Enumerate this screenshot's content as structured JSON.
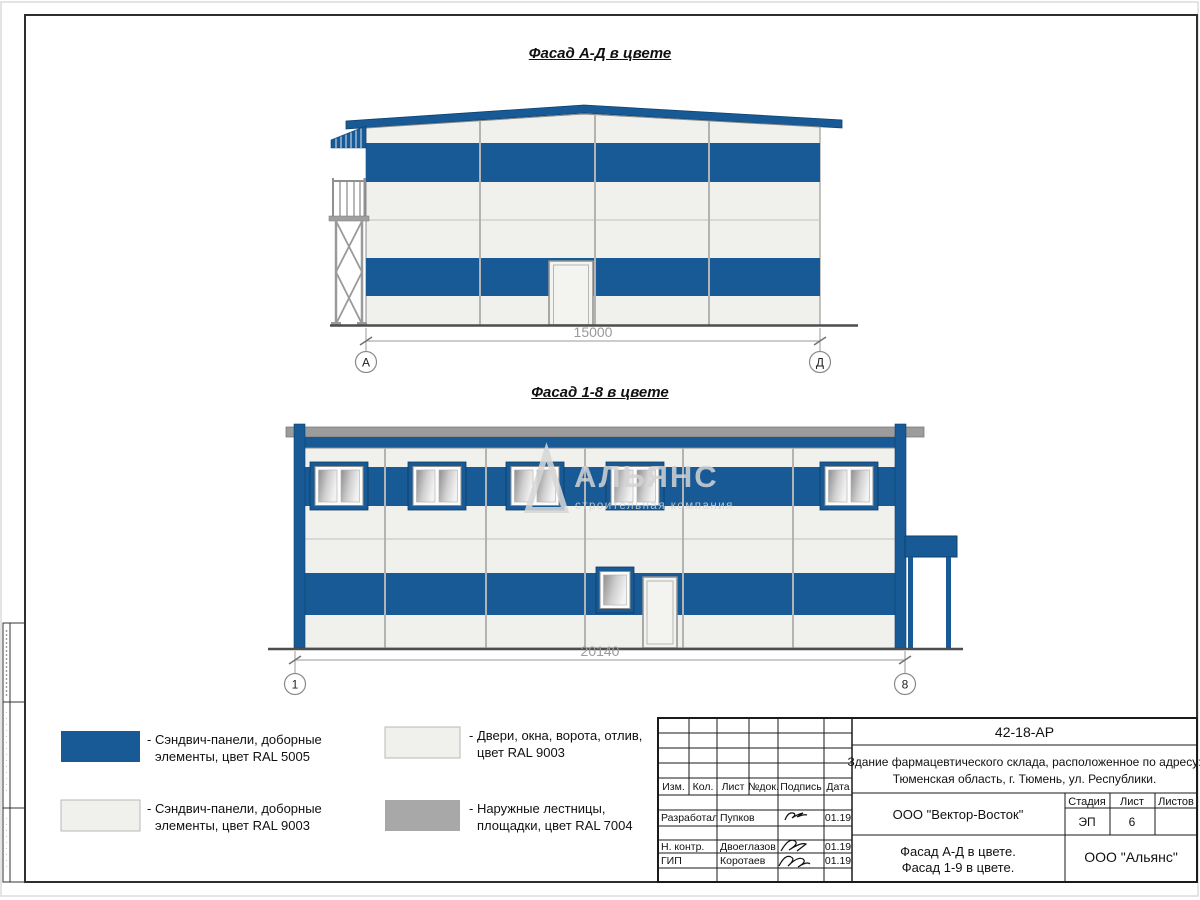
{
  "colors": {
    "blue_ral5005": "#175a96",
    "white_ral9003": "#f0f0ec",
    "gray_ral7004": "#a8a8a8",
    "roof_gray": "#9c9c9c",
    "dim_gray": "#9a9a9a"
  },
  "facade1": {
    "title": "Фасад А-Д в цвете",
    "dimension": "15000",
    "axis_left": "А",
    "axis_right": "Д"
  },
  "facade2": {
    "title": "Фасад 1-8 в цвете",
    "dimension": "20140",
    "axis_left": "1",
    "axis_right": "8"
  },
  "watermark": {
    "name": "АЛЬЯНС",
    "tagline": "строительная компания"
  },
  "legend": {
    "item1_line1": "- Сэндвич-панели, доборные",
    "item1_line2": "элементы, цвет RAL 5005",
    "item2_line1": "- Сэндвич-панели, доборные",
    "item2_line2": "элементы, цвет RAL 9003",
    "item3_line1": "- Двери, окна, ворота, отлив,",
    "item3_line2": "цвет RAL 9003",
    "item4_line1": "- Наружные лестницы,",
    "item4_line2": "площадки, цвет RAL 7004"
  },
  "titleblock": {
    "doc_number": "42-18-АР",
    "project_line1": "Здание фармацевтического склада, расположенное по адресу:",
    "project_line2": "Тюменская область, г. Тюмень, ул. Республики.",
    "col_izm": "Изм.",
    "col_kol": "Кол.",
    "col_list": "Лист",
    "col_ndok": "№док.",
    "col_podpis": "Подпись",
    "col_data": "Дата",
    "row1_role": "Разработал",
    "row1_name": "Пупков",
    "row1_date": "01.19",
    "row2_role": "Н. контр.",
    "row2_name": "Двоеглазов",
    "row2_date": "01.19",
    "row3_role": "ГИП",
    "row3_name": "Коротаев",
    "row3_date": "01.19",
    "company": "ООО \"Вектор-Восток\"",
    "stage_label": "Стадия",
    "sheet_label": "Лист",
    "sheets_label": "Листов",
    "stage_value": "ЭП",
    "sheet_value": "6",
    "sheets_value": "",
    "title_line1": "Фасад А-Д в цвете.",
    "title_line2": "Фасад 1-9 в цвете.",
    "org": "ООО \"Альянс\""
  }
}
